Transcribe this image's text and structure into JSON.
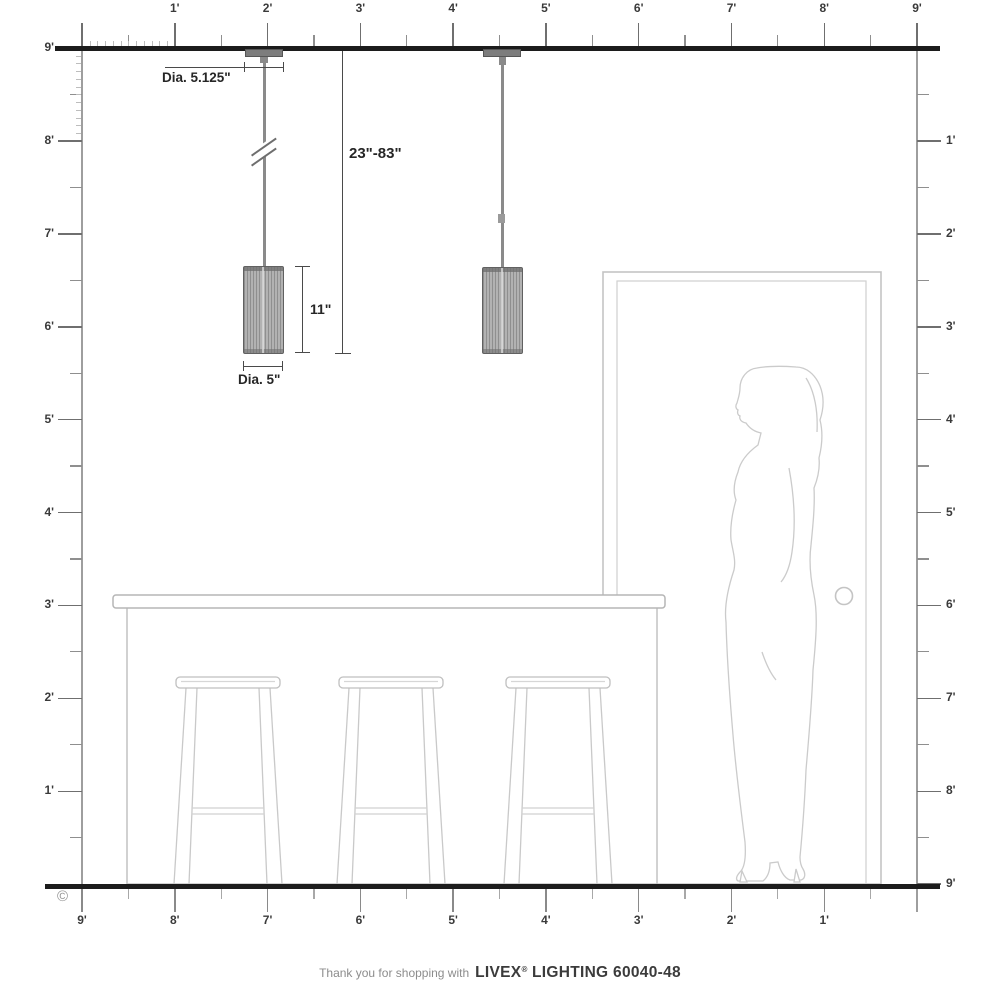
{
  "rulers": {
    "top": {
      "labels": [
        "1'",
        "2'",
        "3'",
        "4'",
        "5'",
        "6'",
        "7'",
        "8'",
        "9'"
      ]
    },
    "left": {
      "labels": [
        "9'",
        "8'",
        "7'",
        "6'",
        "5'",
        "4'",
        "3'",
        "2'",
        "1'"
      ]
    },
    "right": {
      "labels": [
        "1'",
        "2'",
        "3'",
        "4'",
        "5'",
        "6'",
        "7'",
        "8'",
        "9'"
      ]
    },
    "bottom": {
      "labels": [
        "9'",
        "8'",
        "7'",
        "6'",
        "5'",
        "4'",
        "3'",
        "2'",
        "1'"
      ]
    }
  },
  "dimensions": {
    "canopy_diameter": "Dia. 5.125\"",
    "suspension_range": "23\"-83\"",
    "shade_height": "11\"",
    "shade_diameter": "Dia. 5\""
  },
  "footer": {
    "prefix": "Thank you for shopping with",
    "brand": "LIVEX",
    "registered": "®",
    "brand_suffix": " LIGHTING 60040-48"
  },
  "copyright": "©",
  "colors": {
    "structure_ink": "#1c1c1c",
    "ruler_gray": "#9e9e9e",
    "dimension_ink": "#2e2e2e",
    "fixture_gray": "#8a8a8a",
    "background_art_gray": "#c9c9c9"
  }
}
